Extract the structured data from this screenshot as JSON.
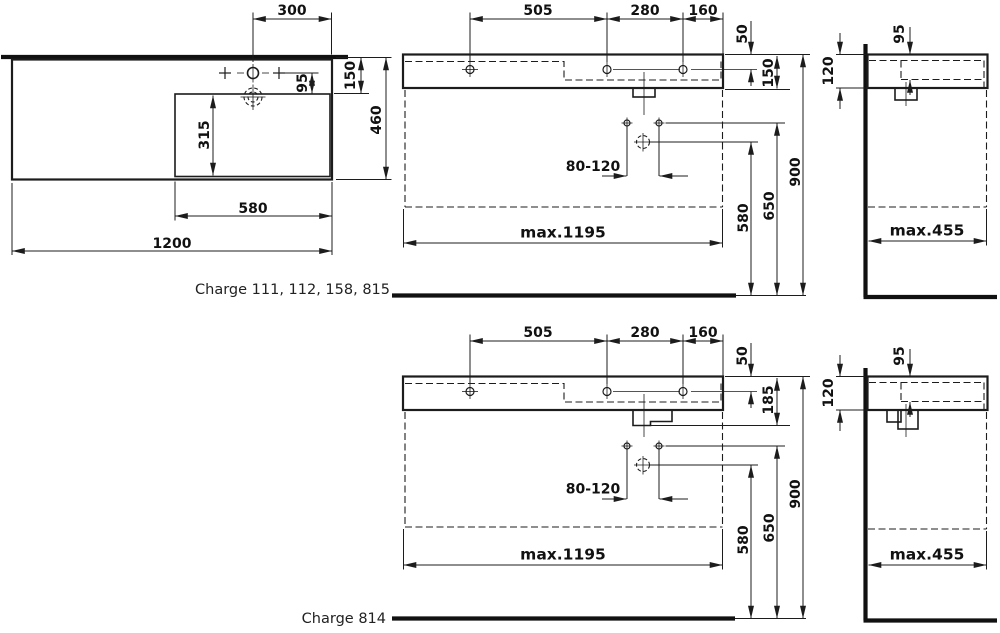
{
  "captions": {
    "top": "Charge 111, 112, 158, 815",
    "bottom": "Charge 814"
  },
  "plan_view": {
    "faucet_offset": "300",
    "rim_to_bowl": "150",
    "faucet_to_bowl": "95",
    "total_depth": "460",
    "bowl_inner_depth": "315",
    "bowl_width": "580",
    "total_width": "1200"
  },
  "front_top": {
    "span_left": "505",
    "span_mid": "280",
    "span_right": "160",
    "rim_to_holes": "50",
    "body_height": "150",
    "fixing_span": "80-120",
    "drain_height": "580",
    "fixing_height": "650",
    "rim_height": "900",
    "max_width": "max.1195"
  },
  "front_bottom": {
    "span_left": "505",
    "span_mid": "280",
    "span_right": "160",
    "rim_to_holes": "50",
    "body_height": "185",
    "fixing_span": "80-120",
    "drain_height": "580",
    "fixing_height": "650",
    "rim_height": "900",
    "max_width": "max.1195"
  },
  "side_top": {
    "bowl_depth": "95",
    "body_height": "120",
    "max_depth": "max.455"
  },
  "side_bottom": {
    "bowl_depth": "95",
    "body_height": "120",
    "max_depth": "max.455"
  }
}
